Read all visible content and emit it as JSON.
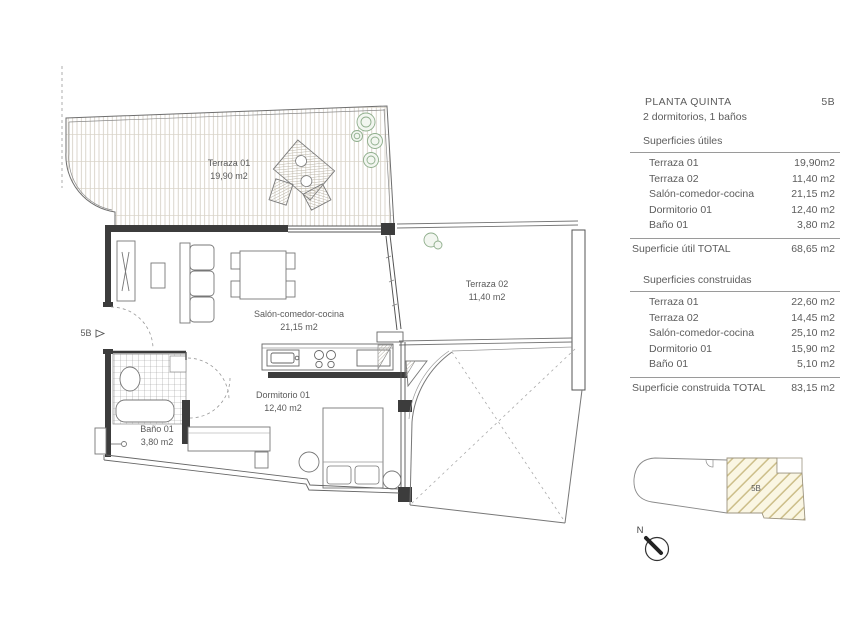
{
  "panel": {
    "title": "PLANTA QUINTA",
    "unit": "5B",
    "subtitle": "2 dormitorios, 1 baños",
    "utiles": {
      "heading": "Superficies útiles",
      "rows": [
        {
          "label": "Terraza 01",
          "value": "19,90m2"
        },
        {
          "label": "Terraza 02",
          "value": "11,40 m2"
        },
        {
          "label": "Salón-comedor-cocina",
          "value": "21,15 m2"
        },
        {
          "label": "Dormitorio 01",
          "value": "12,40 m2"
        },
        {
          "label": "Baño 01",
          "value": "3,80 m2"
        }
      ],
      "total_label": "Superficie útil TOTAL",
      "total_value": "68,65 m2"
    },
    "construidas": {
      "heading": "Superficies construidas",
      "rows": [
        {
          "label": "Terraza 01",
          "value": "22,60 m2"
        },
        {
          "label": "Terraza 02",
          "value": "14,45 m2"
        },
        {
          "label": "Salón-comedor-cocina",
          "value": "25,10 m2"
        },
        {
          "label": "Dormitorio 01",
          "value": "15,90 m2"
        },
        {
          "label": "Baño 01",
          "value": "5,10 m2"
        }
      ],
      "total_label": "Superficie construida TOTAL",
      "total_value": "83,15 m2"
    }
  },
  "plan": {
    "terraza1": {
      "name": "Terraza 01",
      "area": "19,90 m2"
    },
    "terraza2": {
      "name": "Terraza 02",
      "area": "11,40 m2"
    },
    "salon": {
      "name": "Salón-comedor-cocina",
      "area": "21,15 m2"
    },
    "dormitorio": {
      "name": "Dormitorio 01",
      "area": "12,40 m2"
    },
    "bano": {
      "name": "Baño 01",
      "area": "3,80 m2"
    },
    "entrance": "5B",
    "north": "N"
  },
  "locator": {
    "unit": "5B"
  },
  "colors": {
    "wall": "#3c3c3c",
    "deck_line": "#ccc5b8",
    "plant": "#8fae8c",
    "locator_hatch": "#cdbf8a",
    "text": "#5a5a5a"
  }
}
